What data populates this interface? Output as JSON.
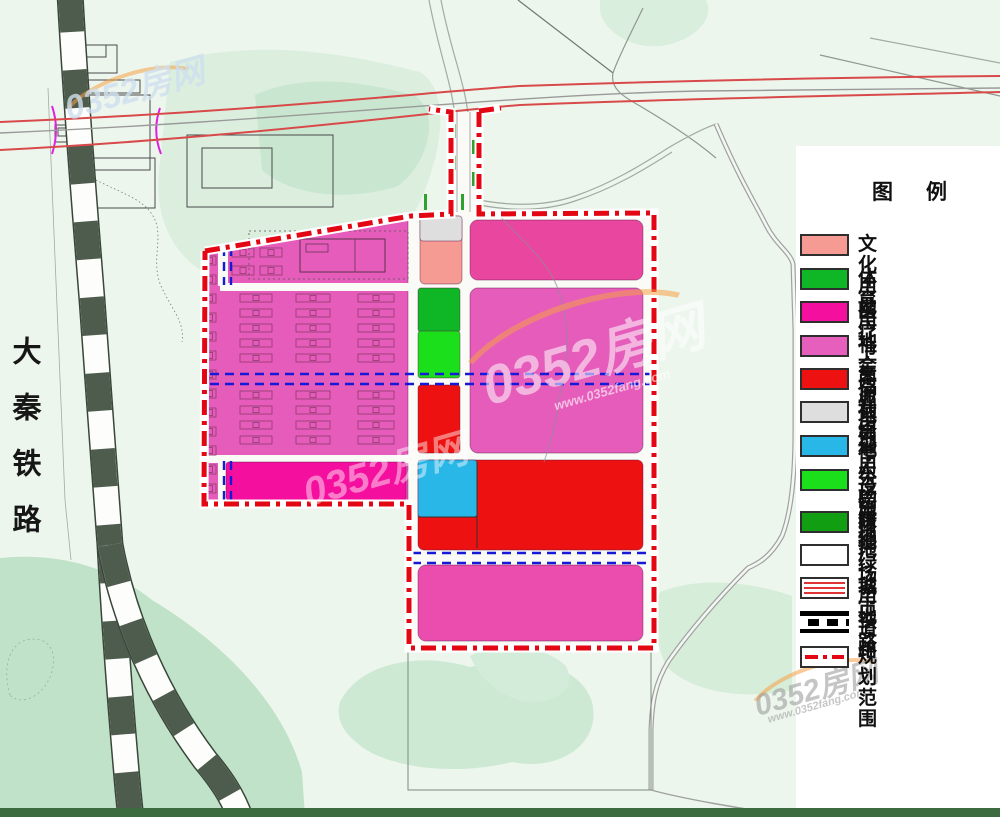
{
  "map_labels": {
    "railway_name": "大秦铁路"
  },
  "watermark": {
    "text": "0352房网",
    "url": "www.0352fang.com"
  },
  "legend": {
    "title": "图　例",
    "items": [
      {
        "label": "文化用地",
        "type": "fill",
        "color": "#F59B93"
      },
      {
        "label": "体育用地",
        "type": "fill",
        "color": "#0FB625"
      },
      {
        "label": "医疗卫生用地",
        "type": "fill",
        "color": "#F50F9E"
      },
      {
        "label": "社会福利用地",
        "type": "fill",
        "color": "#E75FBD"
      },
      {
        "label": "商业用地",
        "type": "fill",
        "color": "#EE1111"
      },
      {
        "label": "社会停车场用地",
        "type": "fill",
        "color": "#DEDEDE"
      },
      {
        "label": "公用设施用地",
        "type": "fill",
        "color": "#29B7E8"
      },
      {
        "label": "公园绿地",
        "type": "fill",
        "color": "#1ADF1A"
      },
      {
        "label": "防护绿地",
        "type": "fill",
        "color": "#129E12"
      },
      {
        "label": "广场用地",
        "type": "fill",
        "color": "#FFFFFF"
      },
      {
        "label": "城市道路",
        "type": "road"
      },
      {
        "label": "铁路",
        "type": "rail"
      },
      {
        "label": "规划范围",
        "type": "boundary",
        "color": "#E30613"
      }
    ]
  },
  "landuse_colors": {
    "culture": "#F59B93",
    "sport": "#0FB625",
    "medical": "#F50F9E",
    "welfare": "#E55CBB",
    "welfare_deep": "#E9479F",
    "welfare_bottom": "#EA4DAE",
    "commercial": "#EE1111",
    "parking": "#DEDEDE",
    "utility": "#29B7E8",
    "park": "#1ADF1A"
  },
  "line_colors": {
    "plan_boundary": "#E30613",
    "control_blue": "#1818D8",
    "city_road_red": "#D84A4A",
    "railway_dark": "#4E5C4E"
  }
}
